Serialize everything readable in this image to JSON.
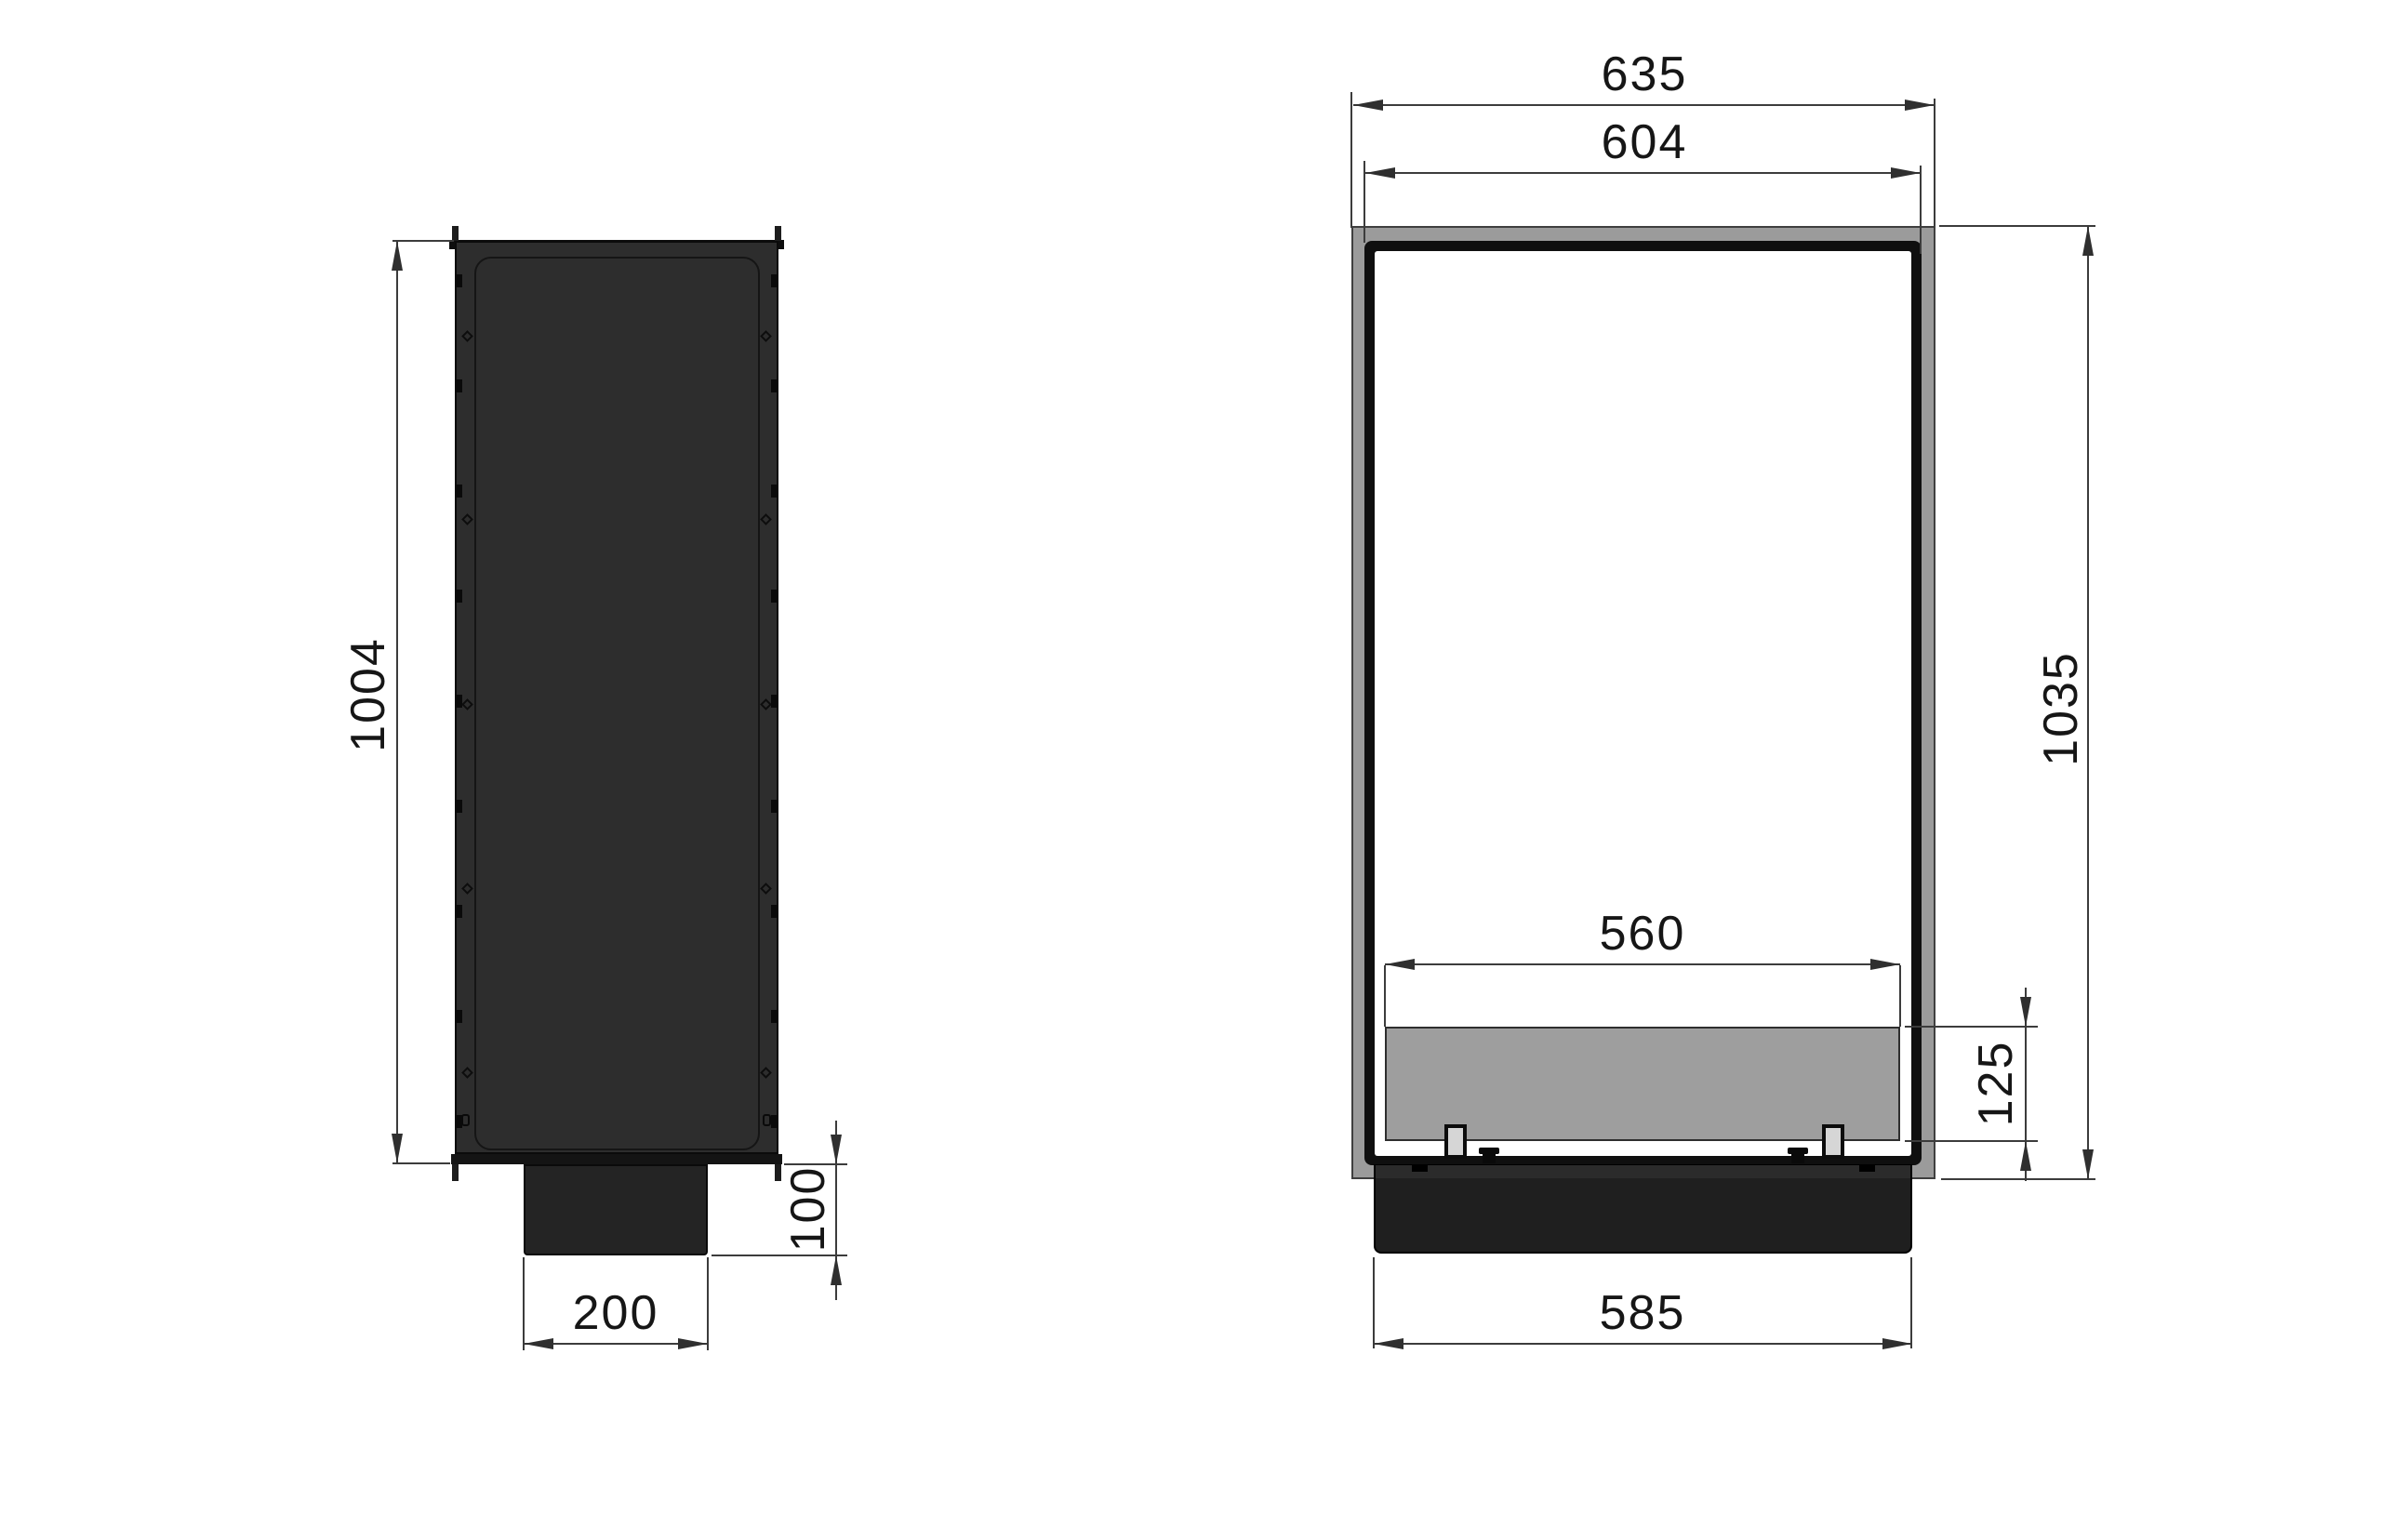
{
  "drawing": {
    "type": "technical-dimension-drawing",
    "views": {
      "side": {
        "label": "side-profile-view",
        "height_mm": "1004",
        "duct_width_mm": "200",
        "duct_height_mm": "100"
      },
      "front": {
        "label": "front-view",
        "overall_width_mm": "635",
        "opening_width_mm": "604",
        "overall_height_mm": "1035",
        "burner_width_mm": "560",
        "burner_height_mm": "125",
        "base_width_mm": "585"
      }
    },
    "colors": {
      "background": "#ffffff",
      "dimension_line": "#3c3c3c",
      "dimension_text": "#161616",
      "side_body_dark": "#2d2d2d",
      "frame_gray": "#9b9b9b",
      "burner_gray": "#9e9e9e",
      "plinth_black": "#1f1f1f",
      "clip_light": "#d6d6d6"
    }
  }
}
